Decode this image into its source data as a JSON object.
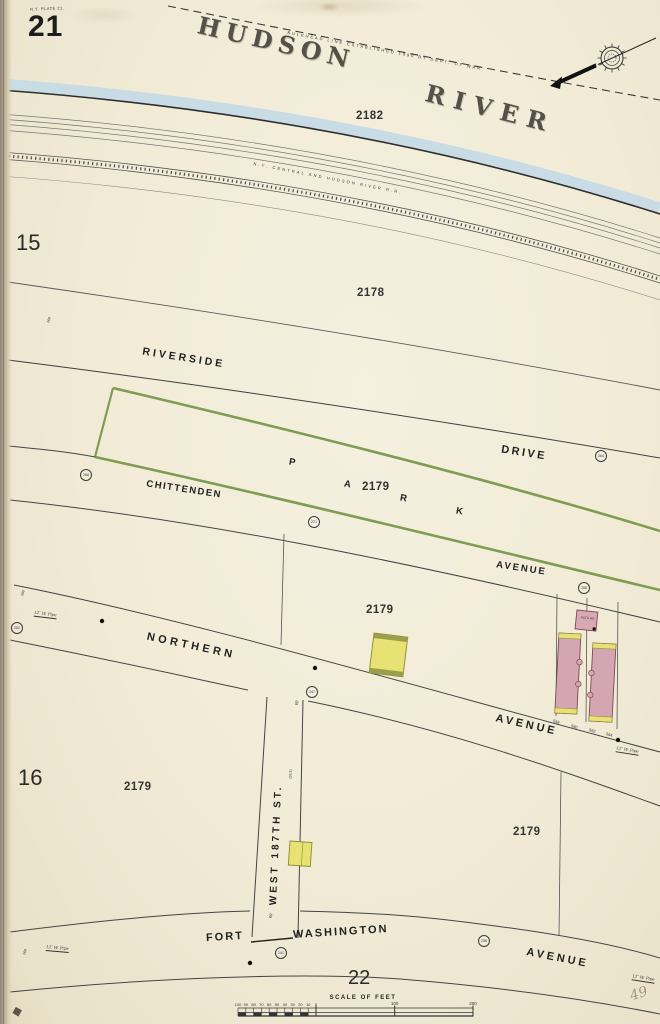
{
  "colors": {
    "paper": "#f1ebd6",
    "water_blue": "#c9dce5",
    "park_green": "#7f9c52",
    "building_pink": "#d4a5b2",
    "building_yellow": "#e8e173",
    "ink": "#2a2a2a"
  },
  "page": {
    "plate_number": "21",
    "plate_note": "N.Y. PLATE 21.",
    "neighbor_top": "15",
    "neighbor_left": "16",
    "neighbor_bottom": "22"
  },
  "river": {
    "word1": "HUDSON",
    "word2": "RIVER",
    "bulkhead": "BULKHEAD LINE ESTABLISHED 1890 BY DEPT. OF WAR",
    "railroad": "N.Y. CENTRAL AND HUDSON RIVER R.R."
  },
  "streets": {
    "riverside": "RIVERSIDE",
    "drive": "DRIVE",
    "park": {
      "p": "P",
      "a": "A",
      "r": "R",
      "k": "K"
    },
    "chittenden": "CHITTENDEN",
    "chittenden_avenue": "AVENUE",
    "northern": "NORTHERN",
    "northern_avenue": "AVENUE",
    "west_187th": "WEST 187TH ST.",
    "west_187th_width": "60'",
    "west_187th_note": "(26.3)",
    "fort_washington_1": "FORT",
    "fort_washington_2": "WASHINGTON",
    "fort_washington_avenue": "AVENUE"
  },
  "block_labels": [
    "2182",
    "2178",
    "2179",
    "2179",
    "2179",
    "2179"
  ],
  "house_numbers": [
    "558",
    "560",
    "562",
    "564"
  ],
  "pipe_note": "12″ W. Pipe",
  "width_marks": [
    "260",
    "260",
    "260",
    "60'"
  ],
  "corner_values": [
    "268",
    "271",
    "264",
    "258",
    "252",
    "247",
    "241",
    "236"
  ],
  "auto_house_label": "AUTO HO.",
  "pencil_note": "49",
  "scale": {
    "title": "SCALE OF FEET",
    "sub_ticks": [
      "100",
      "90",
      "80",
      "70",
      "60",
      "50",
      "40",
      "30",
      "20",
      "10",
      "0"
    ],
    "major_ticks": [
      "100",
      "200"
    ]
  }
}
